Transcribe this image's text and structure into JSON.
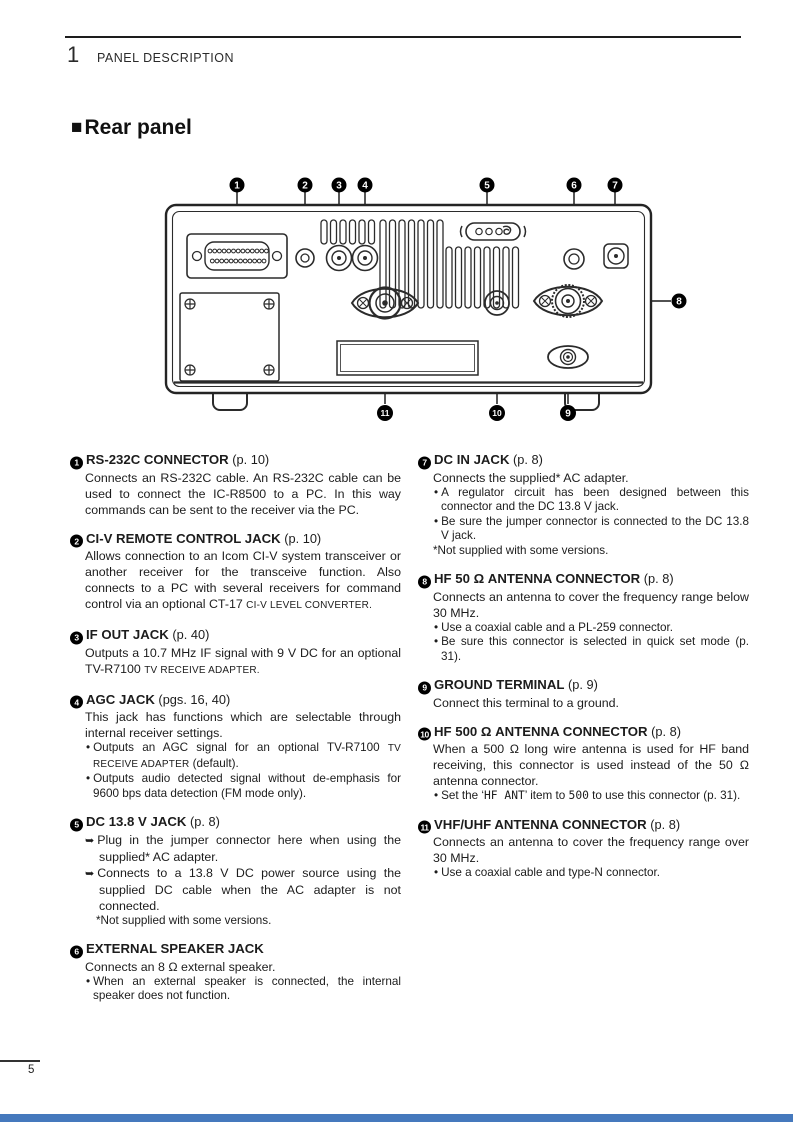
{
  "header": {
    "chapter_number": "1",
    "chapter_title": "PANEL DESCRIPTION"
  },
  "section": {
    "title": "Rear panel"
  },
  "footer": {
    "page_number": "5"
  },
  "colors": {
    "footer_bar": "#4579bd",
    "callout_bg": "#000000",
    "text": "#1c1c1c"
  },
  "icons": {
    "section_marker": "■",
    "bullet": "•",
    "arrow_marker": "➥"
  },
  "diagram": {
    "callouts": [
      "1",
      "2",
      "3",
      "4",
      "5",
      "6",
      "7",
      "8",
      "9",
      "10",
      "11"
    ]
  },
  "items": [
    {
      "num": "1",
      "column": "left",
      "title": "RS-232C CONNECTOR",
      "ref": "(p. 10)",
      "content": [
        {
          "type": "p",
          "runs": [
            {
              "text": "Connects an RS-232C cable. An RS-232C cable can be used to connect the IC-R8500 to a PC. In this way commands can be sent to the receiver via the PC."
            }
          ]
        }
      ]
    },
    {
      "num": "2",
      "column": "left",
      "title": "CI-V REMOTE CONTROL JACK",
      "ref": "(p. 10)",
      "content": [
        {
          "type": "p",
          "runs": [
            {
              "text": "Allows connection to an Icom CI-V system transceiver or another receiver for the transceive function. Also connects to a PC with several receivers for command control via an optional CT-17 "
            },
            {
              "text": "CI-V LEVEL CONVERTER.",
              "style": "sc"
            }
          ]
        }
      ]
    },
    {
      "num": "3",
      "column": "left",
      "title": "IF OUT JACK",
      "ref": "(p. 40)",
      "content": [
        {
          "type": "p",
          "runs": [
            {
              "text": "Outputs a 10.7 MHz IF signal with 9 V DC for an optional TV-R7100 "
            },
            {
              "text": "TV RECEIVE ADAPTER.",
              "style": "sc"
            }
          ]
        }
      ]
    },
    {
      "num": "4",
      "column": "left",
      "title": "AGC JACK",
      "ref": "(pgs. 16, 40)",
      "content": [
        {
          "type": "p",
          "runs": [
            {
              "text": "This jack has functions which are selectable through internal receiver settings."
            }
          ]
        },
        {
          "type": "bullet",
          "runs": [
            {
              "text": "Outputs an AGC signal for an optional TV-R7100 "
            },
            {
              "text": "TV RECEIVE ADAPTER",
              "style": "sc"
            },
            {
              "text": " (default)."
            }
          ]
        },
        {
          "type": "bullet",
          "runs": [
            {
              "text": "Outputs audio detected signal without de-emphasis for 9600 bps data detection (FM mode only)."
            }
          ]
        }
      ]
    },
    {
      "num": "5",
      "column": "left",
      "title": "DC 13.8 V JACK",
      "ref": "(p. 8)",
      "content": [
        {
          "type": "arrow",
          "runs": [
            {
              "text": "Plug in the jumper connector here when using the supplied* AC adapter."
            }
          ]
        },
        {
          "type": "arrow",
          "runs": [
            {
              "text": "Connects to a 13.8 V DC power source using the supplied DC cable when the AC adapter is not connected."
            }
          ]
        },
        {
          "type": "subnote",
          "runs": [
            {
              "text": "*Not supplied with some versions."
            }
          ]
        }
      ]
    },
    {
      "num": "6",
      "column": "left",
      "title": "EXTERNAL SPEAKER JACK",
      "ref": "",
      "content": [
        {
          "type": "p",
          "runs": [
            {
              "text": "Connects an 8 Ω external speaker."
            }
          ]
        },
        {
          "type": "bullet",
          "runs": [
            {
              "text": "When an external speaker is connected, the internal speaker does not function."
            }
          ]
        }
      ]
    },
    {
      "num": "7",
      "column": "right",
      "title": "DC IN JACK",
      "ref": "(p. 8)",
      "content": [
        {
          "type": "p",
          "runs": [
            {
              "text": "Connects the supplied* AC adapter."
            }
          ]
        },
        {
          "type": "bullet",
          "runs": [
            {
              "text": "A regulator circuit has been designed between this connector and the DC 13.8 V jack."
            }
          ]
        },
        {
          "type": "bullet",
          "runs": [
            {
              "text": "Be sure the jumper connector is connected to the DC 13.8 V jack."
            }
          ]
        },
        {
          "type": "note",
          "runs": [
            {
              "text": "*Not supplied with some versions."
            }
          ]
        }
      ]
    },
    {
      "num": "8",
      "column": "right",
      "title": "HF 50 Ω ANTENNA CONNECTOR",
      "ref": "(p. 8)",
      "content": [
        {
          "type": "p",
          "runs": [
            {
              "text": "Connects an antenna to cover the frequency range below 30 MHz."
            }
          ]
        },
        {
          "type": "bullet",
          "runs": [
            {
              "text": "Use a coaxial cable and a PL-259 connector."
            }
          ]
        },
        {
          "type": "bullet",
          "runs": [
            {
              "text": "Be sure this connector is selected in quick set mode (p. 31)."
            }
          ]
        }
      ]
    },
    {
      "num": "9",
      "column": "right",
      "title": "GROUND TERMINAL",
      "ref": "(p. 9)",
      "content": [
        {
          "type": "p",
          "runs": [
            {
              "text": "Connect this terminal to a ground."
            }
          ]
        }
      ]
    },
    {
      "num": "10",
      "column": "right",
      "title": "HF 500 Ω ANTENNA CONNECTOR",
      "ref": "(p. 8)",
      "content": [
        {
          "type": "p",
          "runs": [
            {
              "text": "When a 500 Ω long wire antenna is used for HF band receiving, this connector is used instead of the 50 Ω antenna connector."
            }
          ]
        },
        {
          "type": "bullet",
          "runs": [
            {
              "text": "Set the ‘"
            },
            {
              "text": "HF ANT",
              "style": "mono"
            },
            {
              "text": "’ item to "
            },
            {
              "text": "500",
              "style": "mono"
            },
            {
              "text": " to use this connector (p. 31)."
            }
          ]
        }
      ]
    },
    {
      "num": "11",
      "column": "right",
      "title": "VHF/UHF ANTENNA CONNECTOR",
      "ref": "(p. 8)",
      "content": [
        {
          "type": "p",
          "runs": [
            {
              "text": "Connects an antenna to cover the frequency range over 30 MHz."
            }
          ]
        },
        {
          "type": "bullet",
          "runs": [
            {
              "text": "Use a coaxial cable and type-N connector."
            }
          ]
        }
      ]
    }
  ]
}
